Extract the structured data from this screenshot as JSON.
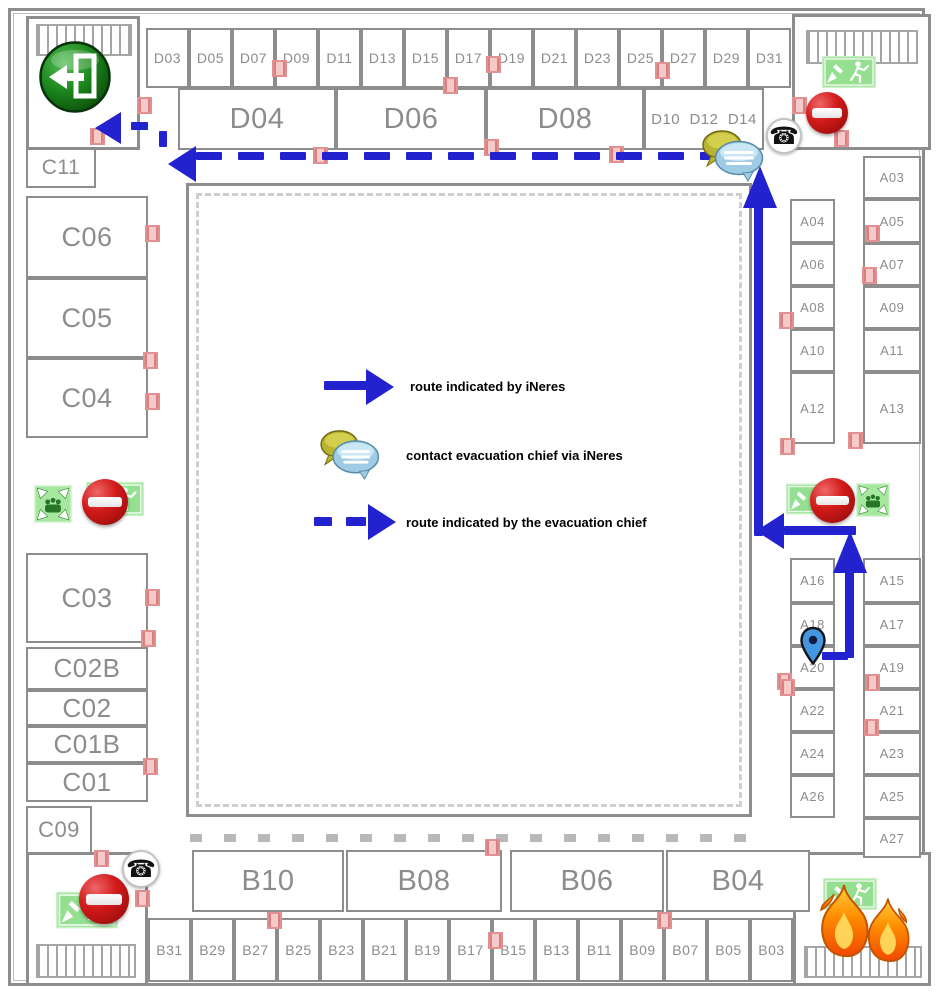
{
  "legend": {
    "items": [
      {
        "symbol": "solid-blue-arrow",
        "label": "route indicated by iNeres"
      },
      {
        "symbol": "chat-bubbles",
        "label": "contact evacuation chief via iNeres"
      },
      {
        "symbol": "dashed-blue-arrow",
        "label": "route indicated by the evacuation chief"
      }
    ]
  },
  "floorplan": {
    "rooms": [
      [
        "D03",
        146,
        28,
        43,
        60,
        14
      ],
      [
        "D05",
        189,
        28,
        43,
        60,
        14
      ],
      [
        "D07",
        232,
        28,
        43,
        60,
        14
      ],
      [
        "D09",
        275,
        28,
        43,
        60,
        14
      ],
      [
        "D11",
        318,
        28,
        43,
        60,
        14
      ],
      [
        "D13",
        361,
        28,
        43,
        60,
        14
      ],
      [
        "D15",
        404,
        28,
        43,
        60,
        14
      ],
      [
        "D17",
        447,
        28,
        43,
        60,
        14
      ],
      [
        "D19",
        490,
        28,
        43,
        60,
        14
      ],
      [
        "D21",
        533,
        28,
        43,
        60,
        14
      ],
      [
        "D23",
        576,
        28,
        43,
        60,
        14
      ],
      [
        "D25",
        619,
        28,
        43,
        60,
        14
      ],
      [
        "D27",
        662,
        28,
        43,
        60,
        14
      ],
      [
        "D29",
        705,
        28,
        43,
        60,
        14
      ],
      [
        "D31",
        748,
        28,
        43,
        60,
        14
      ],
      [
        "D04",
        178,
        88,
        158,
        62,
        29
      ],
      [
        "D06",
        336,
        88,
        150,
        62,
        29
      ],
      [
        "D08",
        486,
        88,
        158,
        62,
        29
      ],
      [
        "D10  D12  D14",
        644,
        88,
        120,
        62,
        15
      ],
      [
        "C11",
        26,
        148,
        70,
        40,
        21
      ],
      [
        "C06",
        26,
        196,
        122,
        82,
        27
      ],
      [
        "C05",
        26,
        278,
        122,
        80,
        27
      ],
      [
        "C04",
        26,
        358,
        122,
        80,
        27
      ],
      [
        "C03",
        26,
        553,
        122,
        90,
        27
      ],
      [
        "C02B",
        26,
        647,
        122,
        43,
        26
      ],
      [
        "C02",
        26,
        690,
        122,
        36,
        26
      ],
      [
        "C01B",
        26,
        726,
        122,
        37,
        26
      ],
      [
        "C01",
        26,
        763,
        122,
        39,
        26
      ],
      [
        "C09",
        26,
        806,
        66,
        48,
        22
      ],
      [
        "A04",
        790,
        199,
        45,
        44,
        13
      ],
      [
        "A06",
        790,
        243,
        45,
        43,
        13
      ],
      [
        "A08",
        790,
        286,
        45,
        43,
        13
      ],
      [
        "A10",
        790,
        329,
        45,
        43,
        13
      ],
      [
        "A12",
        790,
        372,
        45,
        72,
        13
      ],
      [
        "A16",
        790,
        558,
        45,
        45,
        13
      ],
      [
        "A18",
        790,
        603,
        45,
        43,
        13
      ],
      [
        "A20",
        790,
        646,
        45,
        43,
        13
      ],
      [
        "A22",
        790,
        689,
        45,
        43,
        13
      ],
      [
        "A24",
        790,
        732,
        45,
        43,
        13
      ],
      [
        "A26",
        790,
        775,
        45,
        43,
        13
      ],
      [
        "A03",
        863,
        156,
        58,
        43,
        13
      ],
      [
        "A05",
        863,
        199,
        58,
        44,
        13
      ],
      [
        "A07",
        863,
        243,
        58,
        43,
        13
      ],
      [
        "A09",
        863,
        286,
        58,
        43,
        13
      ],
      [
        "A11",
        863,
        329,
        58,
        43,
        13
      ],
      [
        "A13",
        863,
        372,
        58,
        72,
        13
      ],
      [
        "A15",
        863,
        558,
        58,
        45,
        13
      ],
      [
        "A17",
        863,
        603,
        58,
        43,
        13
      ],
      [
        "A19",
        863,
        646,
        58,
        43,
        13
      ],
      [
        "A21",
        863,
        689,
        58,
        43,
        13
      ],
      [
        "A23",
        863,
        732,
        58,
        43,
        13
      ],
      [
        "A25",
        863,
        775,
        58,
        43,
        13
      ],
      [
        "A27",
        863,
        818,
        58,
        40,
        13
      ],
      [
        "B10",
        192,
        850,
        152,
        62,
        29
      ],
      [
        "B08",
        346,
        850,
        156,
        62,
        29
      ],
      [
        "B06",
        510,
        850,
        154,
        62,
        29
      ],
      [
        "B04",
        666,
        850,
        144,
        62,
        29
      ],
      [
        "B31",
        148,
        918,
        43,
        64,
        14
      ],
      [
        "B29",
        191,
        918,
        43,
        64,
        14
      ],
      [
        "B27",
        234,
        918,
        43,
        64,
        14
      ],
      [
        "B25",
        277,
        918,
        43,
        64,
        14
      ],
      [
        "B23",
        320,
        918,
        43,
        64,
        14
      ],
      [
        "B21",
        363,
        918,
        43,
        64,
        14
      ],
      [
        "B19",
        406,
        918,
        43,
        64,
        14
      ],
      [
        "B17",
        449,
        918,
        43,
        64,
        14
      ],
      [
        "B15",
        492,
        918,
        43,
        64,
        14
      ],
      [
        "B13",
        535,
        918,
        43,
        64,
        14
      ],
      [
        "B11",
        578,
        918,
        43,
        64,
        14
      ],
      [
        "B09",
        621,
        918,
        43,
        64,
        14
      ],
      [
        "B07",
        664,
        918,
        43,
        64,
        14
      ],
      [
        "B05",
        707,
        918,
        43,
        64,
        14
      ],
      [
        "B03",
        750,
        918,
        43,
        64,
        14
      ]
    ],
    "doors": [
      [
        137,
        97
      ],
      [
        90,
        128
      ],
      [
        272,
        60
      ],
      [
        443,
        77
      ],
      [
        486,
        56
      ],
      [
        484,
        139
      ],
      [
        313,
        147
      ],
      [
        609,
        146
      ],
      [
        655,
        62
      ],
      [
        792,
        97
      ],
      [
        834,
        130
      ],
      [
        865,
        225
      ],
      [
        862,
        267
      ],
      [
        779,
        312
      ],
      [
        848,
        432
      ],
      [
        780,
        438
      ],
      [
        777,
        673
      ],
      [
        865,
        674
      ],
      [
        780,
        679
      ],
      [
        864,
        719
      ],
      [
        145,
        225
      ],
      [
        143,
        352
      ],
      [
        145,
        393
      ],
      [
        145,
        589
      ],
      [
        141,
        630
      ],
      [
        143,
        758
      ],
      [
        94,
        850
      ],
      [
        135,
        890
      ],
      [
        267,
        912
      ],
      [
        485,
        839
      ],
      [
        488,
        932
      ],
      [
        657,
        912
      ]
    ]
  },
  "routes": {
    "top_dash_y": 152,
    "top_dash_xs": [
      196,
      238,
      280,
      322,
      364,
      406,
      448,
      490,
      532,
      574,
      616,
      658,
      700
    ]
  },
  "icons": {
    "exit_circle": "green-exit-door-left-arrow",
    "phone": "telephone",
    "no_entry": "no-entry-sign",
    "exit_sign": "emergency-exit-running-man",
    "assembly": "assembly-point",
    "fire": "fire-flame",
    "chat": "chat-bubbles",
    "pin": "location-pin"
  },
  "colors": {
    "route_blue": "#2222cf",
    "wall_grey": "#8d8d8d",
    "label_grey": "#8c8c8c",
    "door_pink": "#f7caca",
    "exit_green": "#95e090",
    "no_entry_red": "#d31a1a"
  }
}
